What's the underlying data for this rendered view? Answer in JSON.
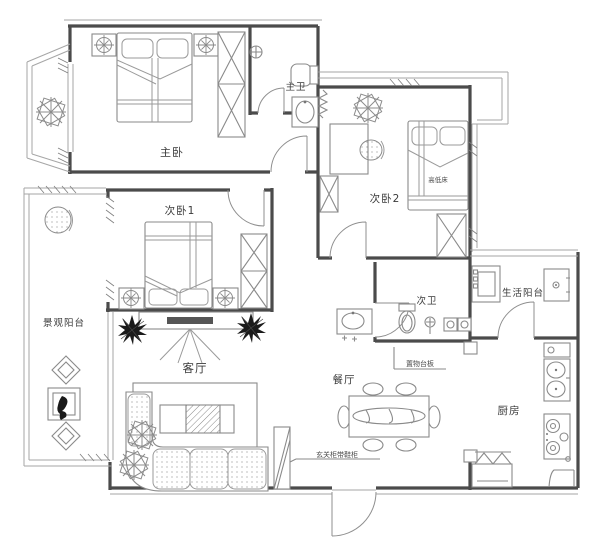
{
  "plan": {
    "title": "三室两厅户型平面布置图",
    "colors": {
      "background": "#ffffff",
      "wall": "#4b4b4b",
      "line": "#8a8a8a",
      "thin": "#a6a6a6",
      "text": "#3a3a3a",
      "dark_fill": "#1a1a1a",
      "tv": "#555555"
    },
    "rooms": [
      {
        "id": "master-bedroom",
        "label": "主卧"
      },
      {
        "id": "master-bathroom",
        "label": "主卫"
      },
      {
        "id": "bedroom-1",
        "label": "次卧1"
      },
      {
        "id": "bedroom-2",
        "label": "次卧2"
      },
      {
        "id": "second-bathroom",
        "label": "次卫"
      },
      {
        "id": "utility-balcony",
        "label": "生活阳台"
      },
      {
        "id": "view-balcony",
        "label": "景观阳台"
      },
      {
        "id": "living-room",
        "label": "客厅"
      },
      {
        "id": "dining-room",
        "label": "餐厅"
      },
      {
        "id": "kitchen",
        "label": "厨房"
      }
    ],
    "annotations": [
      {
        "id": "bunk-bed",
        "label": "高低床"
      },
      {
        "id": "shelf-board",
        "label": "置物台板"
      },
      {
        "id": "entry-cabinet",
        "label": "玄关柜带鞋柜"
      }
    ]
  }
}
